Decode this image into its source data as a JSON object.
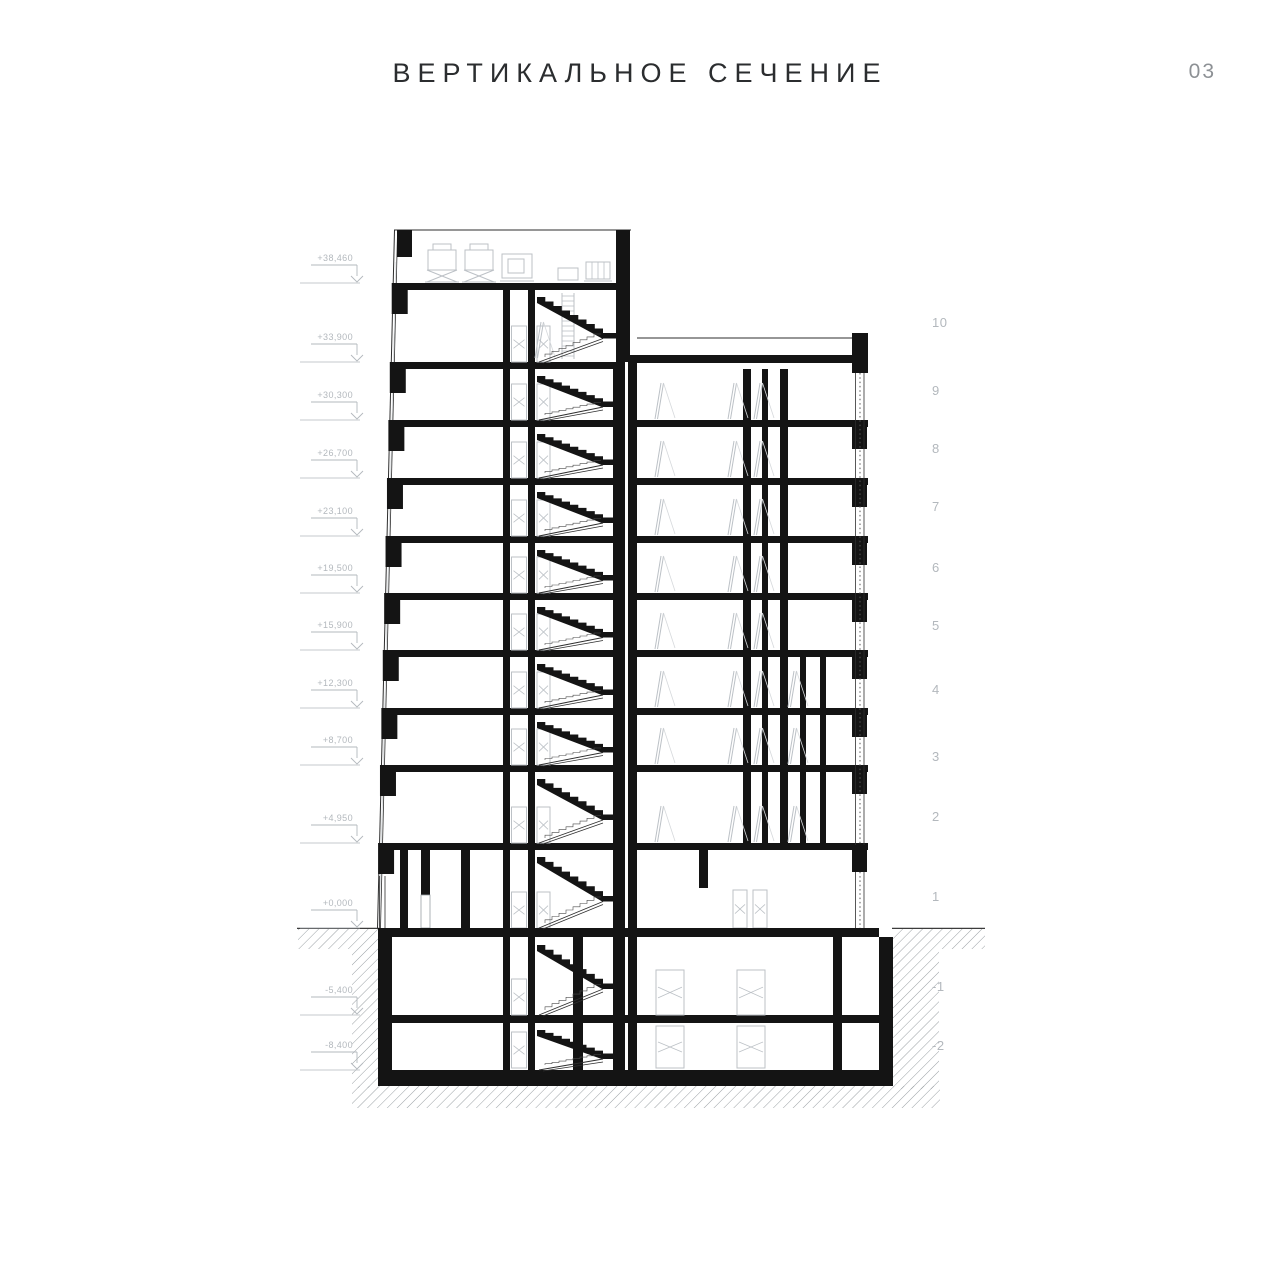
{
  "header": {
    "title": "ВЕРТИКАЛЬНОЕ СЕЧЕНИЕ",
    "page_number": "03"
  },
  "drawing": {
    "elevation_markers": [
      "+38,460",
      "+33,900",
      "+30,300",
      "+26,700",
      "+23,100",
      "+19,500",
      "+15,900",
      "+12,300",
      "+8,700",
      "+4,950",
      "+0,000",
      "-5,400",
      "-8,400"
    ],
    "floor_numbers": [
      "10",
      "9",
      "8",
      "7",
      "6",
      "5",
      "4",
      "3",
      "2",
      "1",
      "-1",
      "-2"
    ],
    "colors": {
      "ink": "#141414",
      "thin": "#2e2e2e",
      "detail_gray": "#bcc1c6",
      "label_gray": "#b3b8bd",
      "hatch_gray": "#8f959a",
      "ground_line": "#3c3c3c",
      "title_color": "#2b2d2f",
      "page_number_color": "#8d9195"
    }
  }
}
